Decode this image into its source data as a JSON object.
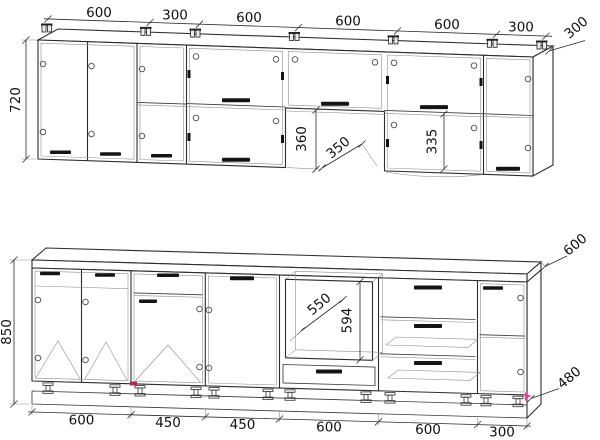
{
  "upper_run": {
    "width_dims": [
      "600",
      "300",
      "600",
      "600",
      "600",
      "300"
    ],
    "height_dim": "720",
    "depth_dim": "300",
    "gap_height_dim": "360",
    "clearance_dim": "350",
    "opening_height_dim": "335"
  },
  "base_run": {
    "width_dims": [
      "600",
      "450",
      "450",
      "600",
      "600",
      "300"
    ],
    "height_dim": "850",
    "worktop_depth_dim": "600",
    "plinth_depth_dim": "480",
    "opening_width_dim": "550",
    "opening_height_dim": "594"
  },
  "colors": {
    "line": "#2d2d2d",
    "handle": "#141414",
    "accent_red": "#b5295a",
    "accent_magenta": "#e83fa5",
    "background": "#ffffff"
  }
}
